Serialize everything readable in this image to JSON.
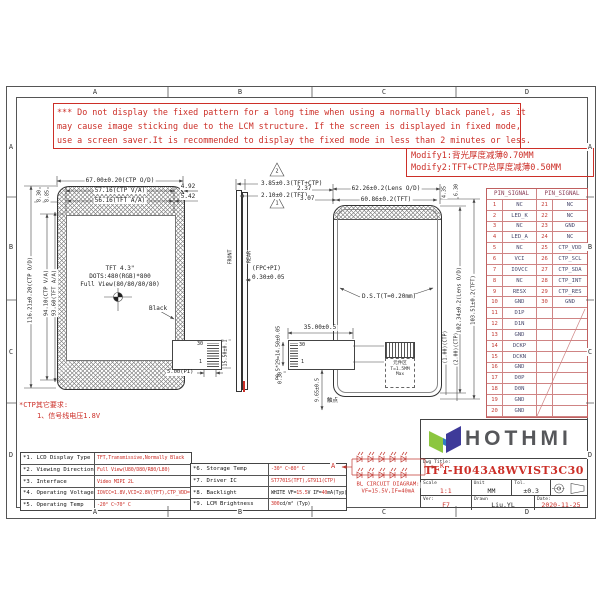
{
  "sheet": {
    "zones_h": [
      "A",
      "B",
      "C",
      "D"
    ],
    "zones_v": [
      "A",
      "B",
      "C",
      "D"
    ]
  },
  "warning": {
    "lines": [
      "*** Do not display the fixed pattern for a long time when using a normally black panel, as it",
      "may cause image sticking due to the LCM structure. If the screen is displayed in fixed mode,",
      "use a screen saver.It is recommended to display the fixed mode in less than 2 minutes or less."
    ]
  },
  "modify": {
    "line1": "Modify1:背光厚度减薄0.70MM",
    "line2": "Modify2:TFT+CTP总厚度减薄0.50MM"
  },
  "ctp_note": {
    "line1": "*CTP其它要求:",
    "line2": "1、信号线电压1.8V"
  },
  "pin_table": {
    "header_left": "PIN_SIGNAL",
    "header_right": "PIN_SIGNAL",
    "rows": [
      [
        "1",
        "NC",
        "21",
        "NC"
      ],
      [
        "2",
        "LED_K",
        "22",
        "NC"
      ],
      [
        "3",
        "NC",
        "23",
        "GND"
      ],
      [
        "4",
        "LED_A",
        "24",
        "NC"
      ],
      [
        "5",
        "NC",
        "25",
        "CTP_VDD"
      ],
      [
        "6",
        "VCI",
        "26",
        "CTP_SCL"
      ],
      [
        "7",
        "IOVCC",
        "27",
        "CTP_SDA"
      ],
      [
        "8",
        "NC",
        "28",
        "CTP_INT"
      ],
      [
        "9",
        "RESX",
        "29",
        "CTP_RES"
      ],
      [
        "10",
        "GND",
        "30",
        "GND"
      ],
      [
        "11",
        "D1P",
        "",
        ""
      ],
      [
        "12",
        "D1N",
        "",
        ""
      ],
      [
        "13",
        "GND",
        "",
        ""
      ],
      [
        "14",
        "DCKP",
        "",
        ""
      ],
      [
        "15",
        "DCKN",
        "",
        ""
      ],
      [
        "16",
        "GND",
        "",
        ""
      ],
      [
        "17",
        "D0P",
        "",
        ""
      ],
      [
        "18",
        "D0N",
        "",
        ""
      ],
      [
        "19",
        "GND",
        "",
        ""
      ],
      [
        "20",
        "GND",
        "",
        ""
      ]
    ]
  },
  "front_view": {
    "dims": {
      "top_od": "67.00±0.20(CTP O/D)",
      "top_va": "57.16(CTP V/A)",
      "top_aa": "56.16(TFT A/A)",
      "r1": "4.92",
      "r2": "5.42",
      "l1": "8.30",
      "l2": "8.85",
      "v_od": "116.21±0.20(CTP O/D)",
      "v_va": "94.10(CTP V/A)",
      "v_aa": "93.60(TFT A/A)"
    },
    "center": {
      "t1": "TFT 4.3\"",
      "t2": "DOTS:480(RGB)*800",
      "t3": "Full View(80/80/80/80)"
    },
    "black_label": "Black"
  },
  "side_view": {
    "d1": "3.85±0.3(TFT+CTP)",
    "d2": "2.10±0.2(TFT)",
    "d3": "2.37",
    "d4": "3.07",
    "front": "FRONT",
    "rear": "REAR",
    "fpc": "(FPC+PI)",
    "fpc_t": "0.30±0.05",
    "tri1": "1",
    "tri2": "2"
  },
  "back_view": {
    "top_od": "62.26±0.2(Lens O/D)",
    "top_tft": "60.86±0.2(TFT)",
    "r1": "4.35",
    "r2": "6.30",
    "v_od": "102.34±0.2(Lens O/D)",
    "v_tft": "103.51±0.2(TFT)",
    "dst": "D.S.T(T=0.20mm)",
    "b1": "(1.00)(CTP)",
    "b2": "(2.00)(CTP)",
    "comp1": "元件区",
    "comp2": "T=1.5MM",
    "comp3": "Max"
  },
  "fpc": {
    "pin30": "30",
    "pin1": "1",
    "pi": "5.00(PI)",
    "h": "15.50±0.1",
    "w": "35.00±0.5",
    "pitch": "P0.5*29=14.50±0.05",
    "t": "0.30",
    "h2": "9.65±0.5",
    "contact": "触点"
  },
  "bl_circuit": {
    "a": "A",
    "k": "K",
    "line1": "BL CIRCUIT DIAGRAM:",
    "line2": "VF=15.5V,IF=40mA"
  },
  "spec_left": {
    "rows": [
      {
        "label": "*1. LCD Display Type",
        "value": "TFT,Transmissive,Normally Black"
      },
      {
        "label": "*2. Viewing Direction",
        "value": "Full View(U80/D80/R80/L80)"
      },
      {
        "label": "*3. Interface",
        "value": "Video MIPI 2L"
      },
      {
        "label": "*4. Operating Voltage",
        "value": "IOVCC=1.8V,VCI=2.8V(TFT),CTP_VDD=2.8V"
      },
      {
        "label": "*5. Operating Temp",
        "value": "-20° C~70° C"
      }
    ]
  },
  "spec_mid": {
    "r6": {
      "label": "*6. Storage Temp",
      "value": "-30° C~80° C"
    },
    "r7": {
      "label": "*7. Driver IC",
      "value": "ST7701S(TFT),GT911(CTP)"
    },
    "r8": {
      "label": "*8. Backlight",
      "p1": "WHITE VF=",
      "p2": "15.5",
      "p3": " V IF= ",
      "p4": "40",
      "p5": "mA(Typ)"
    },
    "r9": {
      "label": "*9. LCM Brightness",
      "p1": "300",
      "p2": " cd/m² (Typ)"
    }
  },
  "title_block": {
    "brand": "HOTHMI",
    "dwg_title_label": "Dwg Title:",
    "title": "TFT-H043A8WVIST3C30",
    "scale_label": "Scale",
    "scale": "1:1",
    "unit_label": "Unit",
    "unit": "MM",
    "tol_label": "Tol.",
    "tol": "±0.3",
    "ver_label": "Ver:",
    "ver": "F7",
    "drawn_label": "Drawn",
    "drawn": "Liu.YL",
    "date_label": "Date:",
    "date": "2020-11-25"
  },
  "colors": {
    "red": "#cc2f28",
    "table_line": "#cf8484",
    "pin_number": "#c23b35",
    "pin_signal": "#4a4a6e",
    "logo_green": "#8cc63f",
    "logo_blue": "#3e3a99",
    "line": "#3a3a3a"
  }
}
